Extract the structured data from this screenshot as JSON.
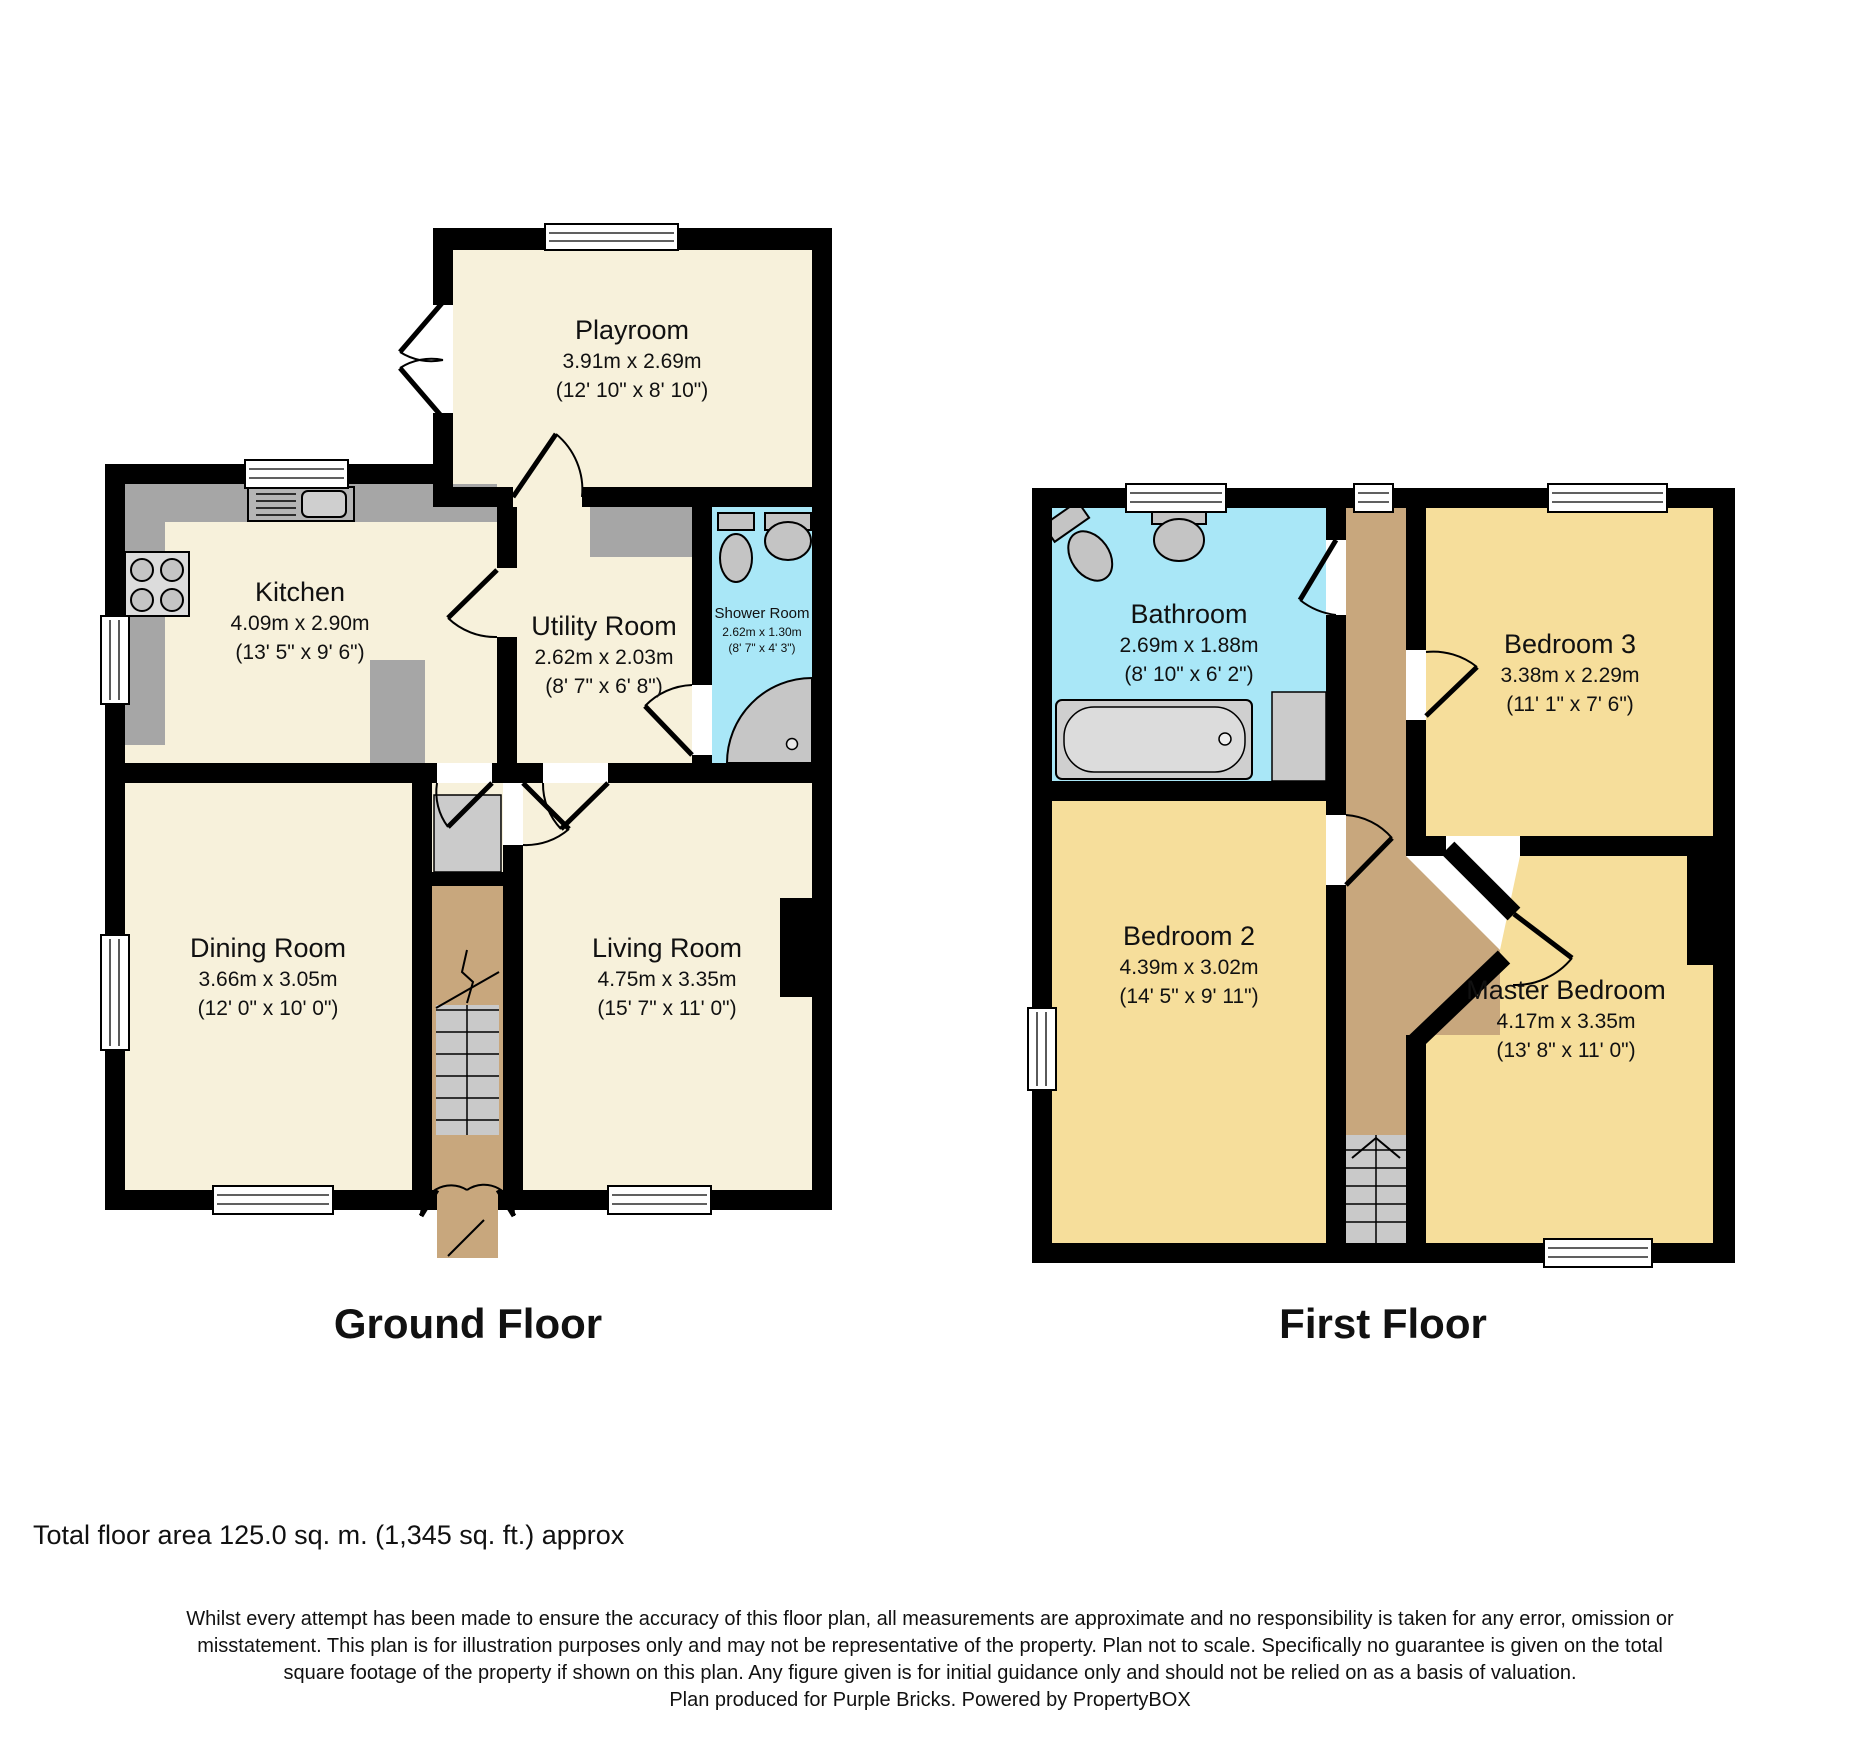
{
  "colors": {
    "wall": "#000000",
    "room_cream": "#F7F1DB",
    "room_yellow": "#F6DE9B",
    "room_blue": "#A9E7F7",
    "hall_tan": "#C8A77D",
    "counter_gray": "#A6A6A6",
    "fixture_gray": "#C4C4C4",
    "stair_gray": "#C9C9C9"
  },
  "ground_floor": {
    "label": "Ground Floor",
    "rooms": {
      "playroom": {
        "name": "Playroom",
        "dims_m": "3.91m x 2.69m",
        "dims_ft": "(12' 10\" x 8' 10\")"
      },
      "kitchen": {
        "name": "Kitchen",
        "dims_m": "4.09m x 2.90m",
        "dims_ft": "(13' 5\" x 9' 6\")"
      },
      "utility": {
        "name": "Utility Room",
        "dims_m": "2.62m x 2.03m",
        "dims_ft": "(8' 7\" x 6' 8\")"
      },
      "shower": {
        "name": "Shower Room",
        "dims_m": "2.62m x 1.30m",
        "dims_ft": "(8' 7\" x 4' 3\")"
      },
      "dining": {
        "name": "Dining Room",
        "dims_m": "3.66m x 3.05m",
        "dims_ft": "(12' 0\" x 10' 0\")"
      },
      "living": {
        "name": "Living Room",
        "dims_m": "4.75m x 3.35m",
        "dims_ft": "(15' 7\" x 11' 0\")"
      }
    }
  },
  "first_floor": {
    "label": "First Floor",
    "rooms": {
      "bathroom": {
        "name": "Bathroom",
        "dims_m": "2.69m x 1.88m",
        "dims_ft": "(8' 10\" x 6' 2\")"
      },
      "bedroom3": {
        "name": "Bedroom 3",
        "dims_m": "3.38m x 2.29m",
        "dims_ft": "(11' 1\" x 7' 6\")"
      },
      "bedroom2": {
        "name": "Bedroom 2",
        "dims_m": "4.39m x 3.02m",
        "dims_ft": "(14' 5\" x 9' 11\")"
      },
      "master": {
        "name": "Master Bedroom",
        "dims_m": "4.17m x 3.35m",
        "dims_ft": "(13' 8\" x 11' 0\")"
      }
    }
  },
  "footer": {
    "total_area": "Total floor area 125.0 sq. m. (1,345 sq. ft.) approx",
    "disclaimer": [
      "Whilst every attempt has been made to ensure the accuracy of this floor plan, all measurements are approximate and no responsibility is taken for any error, omission or",
      "misstatement. This plan is for illustration purposes only and may not be representative of the property. Plan not to scale. Specifically no guarantee is given on the total",
      "square footage of the property if shown on this plan. Any figure given is for initial guidance only and should not be relied on as a basis of valuation.",
      "Plan produced for Purple Bricks. Powered by PropertyBOX"
    ]
  }
}
